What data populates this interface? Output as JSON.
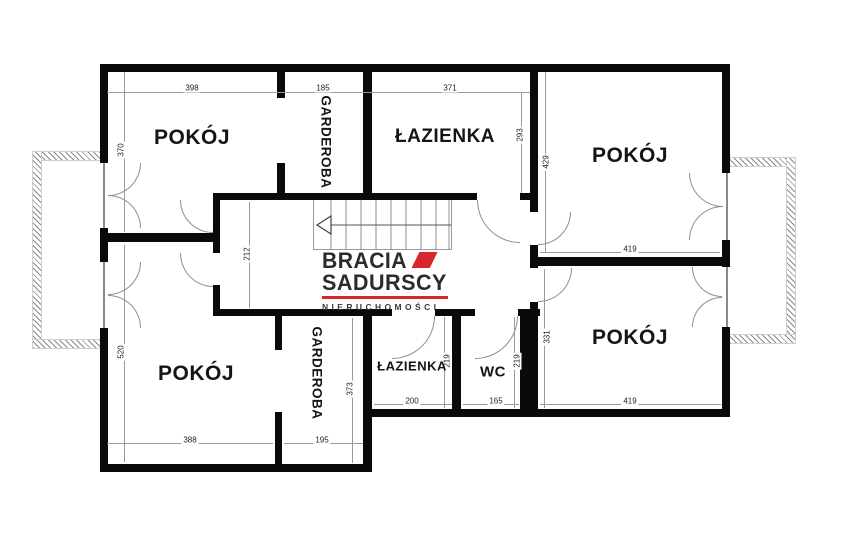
{
  "meta": {
    "type": "floor-plan",
    "language": "pl"
  },
  "rooms": {
    "pokoj_tl": "POKÓJ",
    "garderoba_top": "GARDEROBA",
    "lazienka_top": "ŁAZIENKA",
    "pokoj_tr": "POKÓJ",
    "pokoj_bl": "POKÓJ",
    "garderoba_bottom": "GARDEROBA",
    "lazienka_bottom": "ŁAZIENKA",
    "wc": "WC",
    "pokoj_br": "POKÓJ"
  },
  "dims": {
    "room_tl_width": "398",
    "wardrobe_top_width": "185",
    "bath_top_width": "371",
    "room_tl_height": "370",
    "room_tr_height": "429",
    "bath_top_height": "293",
    "hall_depth": "212",
    "room_tr_width": "419",
    "room_bl_height": "520",
    "room_bl_width": "388",
    "wardrobe_bottom_width": "195",
    "wardrobe_bottom_height": "373",
    "bath_bottom_width": "200",
    "bath_bottom_height": "219",
    "wc_width": "165",
    "wc_height": "219",
    "room_br_height": "331",
    "room_br_width": "419"
  },
  "logo": {
    "brand_line1": "BRACIA",
    "brand_line2": "SADURSCY",
    "brand_line3": "NIERUCHOMOŚCI"
  },
  "colors": {
    "wall": "#0a0a0a",
    "thin_line": "#9a9a9a",
    "accent_red": "#d9252c",
    "text": "#151515",
    "background": "#ffffff"
  }
}
